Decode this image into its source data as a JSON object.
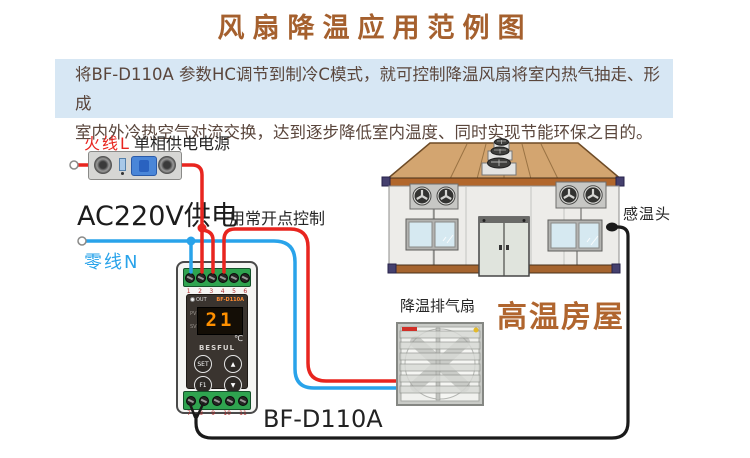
{
  "title": "风扇降温应用范例图",
  "description": {
    "line1": "将BF-D110A 参数HC调节到制冷C模式，就可控制降温风扇将室内热气抽走、形成",
    "line2": "室内外冷热空气对流交换，达到逐步降低室内温度、同时实现节能环保之目的。"
  },
  "labels": {
    "live_wire": "火线L",
    "power_source": "单相供电电源",
    "power_supply": "AC220V供电",
    "neutral_wire": "零线N",
    "no_contact_control": "用常开点控制",
    "exhaust_fan": "降温排气扇",
    "hot_house": "高温房屋",
    "temp_sensor": "感温头",
    "model": "BF-D110A"
  },
  "controller": {
    "out_label": "OUT",
    "brand_top": "BF-D110A",
    "pv_label": "PV",
    "sv_label": "SV",
    "display_value": "21",
    "unit": "℃",
    "brand": "BESFUL",
    "buttons": [
      "SET",
      "▲",
      "F1",
      "▼"
    ],
    "terminal_numbers_top": [
      "1",
      "2",
      "3",
      "4",
      "5",
      "6"
    ],
    "terminal_numbers_bottom": [
      "7",
      "8",
      "9",
      "10",
      "11"
    ]
  },
  "colors": {
    "title": "#a5602e",
    "desc_bg": "#d7e7f4",
    "desc_text": "#5a463c",
    "wire_red": "#e8251f",
    "wire_blue": "#29a3ea",
    "wire_black": "#1a1a1a",
    "accent_brown": "#b0652e",
    "terminal_green": "#2fa34f",
    "display_orange": "#ff9000"
  }
}
